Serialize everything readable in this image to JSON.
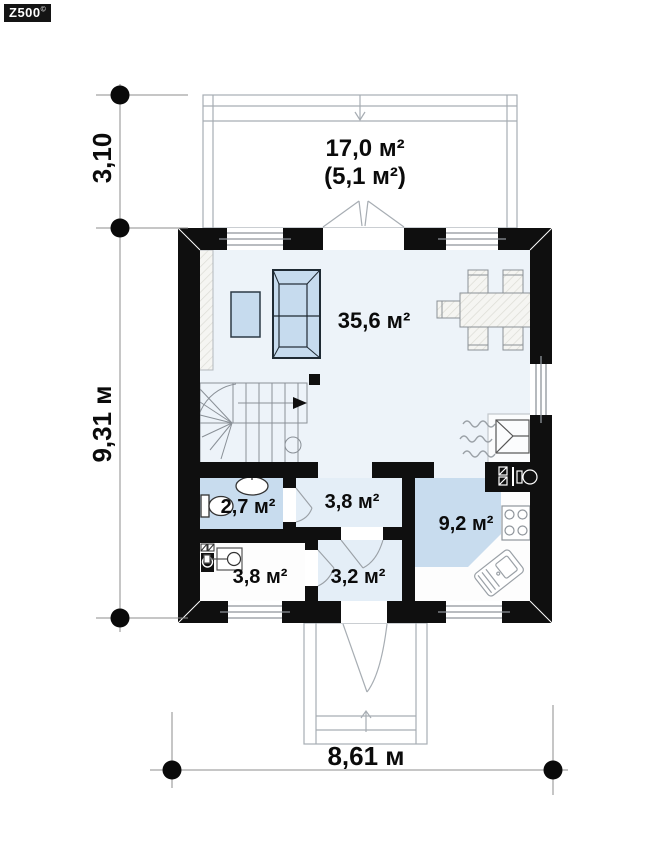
{
  "logo": {
    "brand": "Z500",
    "mark": "©"
  },
  "rooms": {
    "terrace": {
      "area": "17,0 м²",
      "area_secondary": "(5,1 м²)"
    },
    "living": {
      "area": "35,6 м²"
    },
    "bathroom": {
      "area": "2,7 м²"
    },
    "hall": {
      "area": "3,8 м²"
    },
    "kitchen": {
      "area": "9,2 м²"
    },
    "utility": {
      "area": "3,8 м²"
    },
    "entry": {
      "area": "3,2 м²"
    }
  },
  "dimensions": {
    "terrace_depth": "3,10",
    "house_depth": "9,31 м",
    "house_width": "8,61 м"
  },
  "fixtures": [
    "sofa",
    "coffee-table",
    "dining-table",
    "chairs",
    "wardrobe",
    "staircase",
    "fireplace",
    "chimney",
    "toilet",
    "washbasin",
    "washing-machine",
    "boiler",
    "stove",
    "kitchen-sink"
  ],
  "colors": {
    "wall": "#0f0f0f",
    "floor_light": "#edf3f9",
    "floor_medium": "#e4eef7",
    "floor_blue": "#c8dcee",
    "furniture_blue": "#c6dbee",
    "floor_white": "#fdfdfd",
    "outline_gray": "#9aa0a6",
    "dim_gray": "#8c8c8c"
  }
}
